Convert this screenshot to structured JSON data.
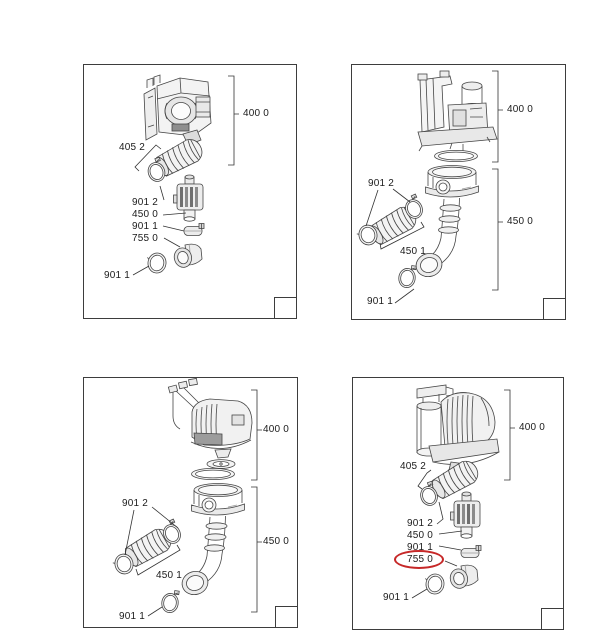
{
  "colors": {
    "line": "#3d3d3d",
    "text": "#1b1b1b",
    "highlight": "#c62828"
  },
  "annotation": {
    "type": "red-ellipse",
    "highlighted_label": "755 0",
    "panel": "variant-bottom-right",
    "color": "#c62828"
  },
  "panels": [
    {
      "name": "variant-top-left",
      "labels": {
        "group_400": "400 0",
        "hose_group_405": "405 2",
        "clamp_upper": "901 2",
        "pipe_assembly": "450 0",
        "clamp_small": "901 1",
        "elbow": "755 0",
        "ring_bottom": "901 1"
      }
    },
    {
      "name": "variant-top-right",
      "labels": {
        "group_400": "400 0",
        "group_450": "450 0",
        "clamps_pair": "901 2",
        "hose_kit": "450 1",
        "clamp_bottom": "901 1"
      }
    },
    {
      "name": "variant-bottom-left",
      "labels": {
        "group_400": "400 0",
        "group_450": "450 0",
        "clamps_pair": "901 2",
        "hose_kit": "450 1",
        "clamp_bottom": "901 1"
      }
    },
    {
      "name": "variant-bottom-right",
      "labels": {
        "group_400": "400 0",
        "hose_group_405": "405 2",
        "clamp_upper": "901 2",
        "pipe_assembly": "450 0",
        "clamp_small": "901 1",
        "elbow_circled": "755 0",
        "ring_bottom": "901 1"
      }
    }
  ]
}
